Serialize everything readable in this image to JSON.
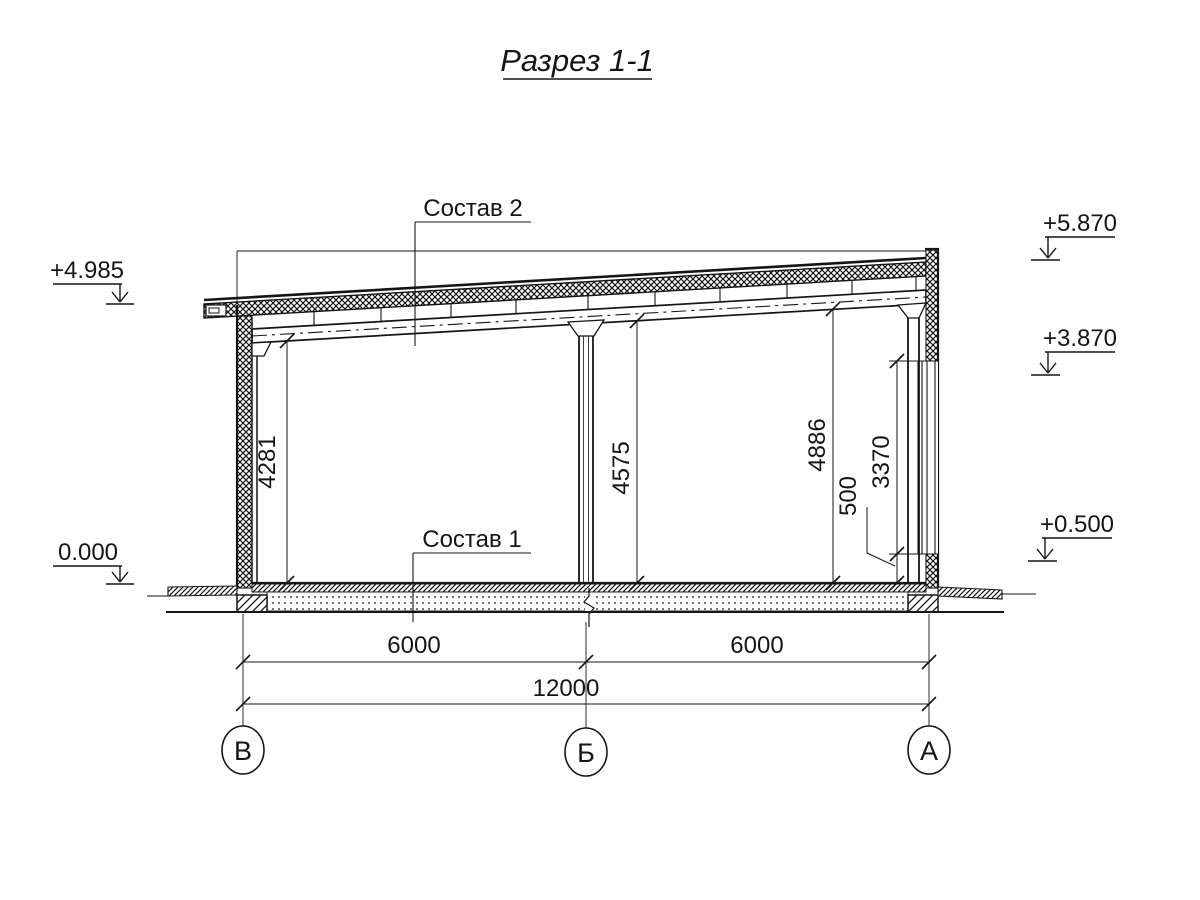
{
  "title": "Разрез 1-1",
  "labels": {
    "roof_composition": "Состав 2",
    "floor_composition": "Состав 1"
  },
  "elevations": {
    "left_top": "+4.985",
    "left_zero": "0.000",
    "right_top": "+5.870",
    "right_mid": "+3.870",
    "right_low": "+0.500"
  },
  "dimensions": {
    "height_left": "4281",
    "height_mid": "4575",
    "height_right": "4886",
    "window": "3370",
    "sill": "500",
    "span_left": "6000",
    "span_right": "6000",
    "total": "12000"
  },
  "axes": {
    "left": "В",
    "mid": "Б",
    "right": "А"
  },
  "colors": {
    "ink": "#151515",
    "paper": "#ffffff"
  }
}
